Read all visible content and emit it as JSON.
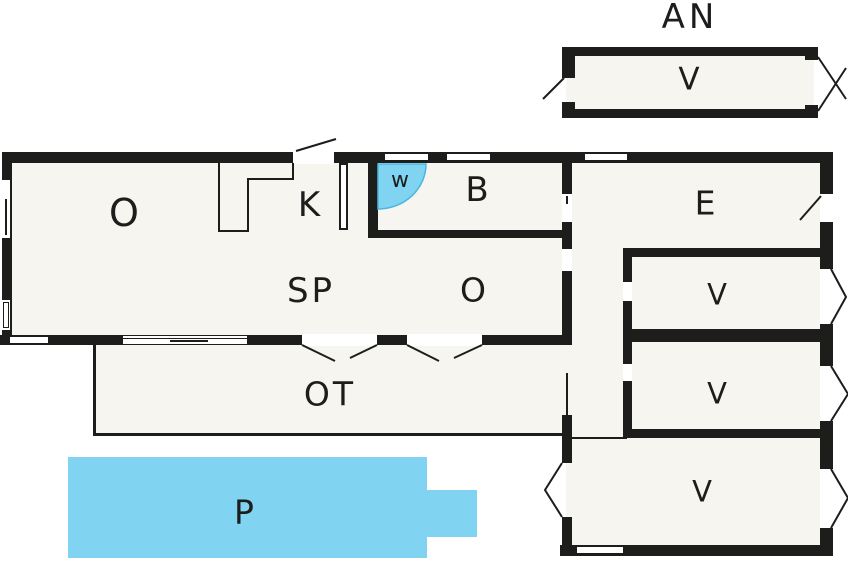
{
  "plan": {
    "title_note": "floor plan",
    "labels": {
      "annex_title": "AN",
      "annex_room": "V",
      "room_o_left": "O",
      "kitchen": "K",
      "wc": "w",
      "bathroom": "B",
      "entrance": "E",
      "room_sp": "SP",
      "room_o_mid": "O",
      "bedroom_1": "V",
      "bedroom_2": "V",
      "bedroom_3": "V",
      "terrace": "OT",
      "pool": "P"
    },
    "colors": {
      "wall": "#1d1d1b",
      "floor": "#f6f5f0",
      "water": "#80d4f2",
      "water_edge": "#4ab6de",
      "text": "#1d1d1b"
    }
  }
}
